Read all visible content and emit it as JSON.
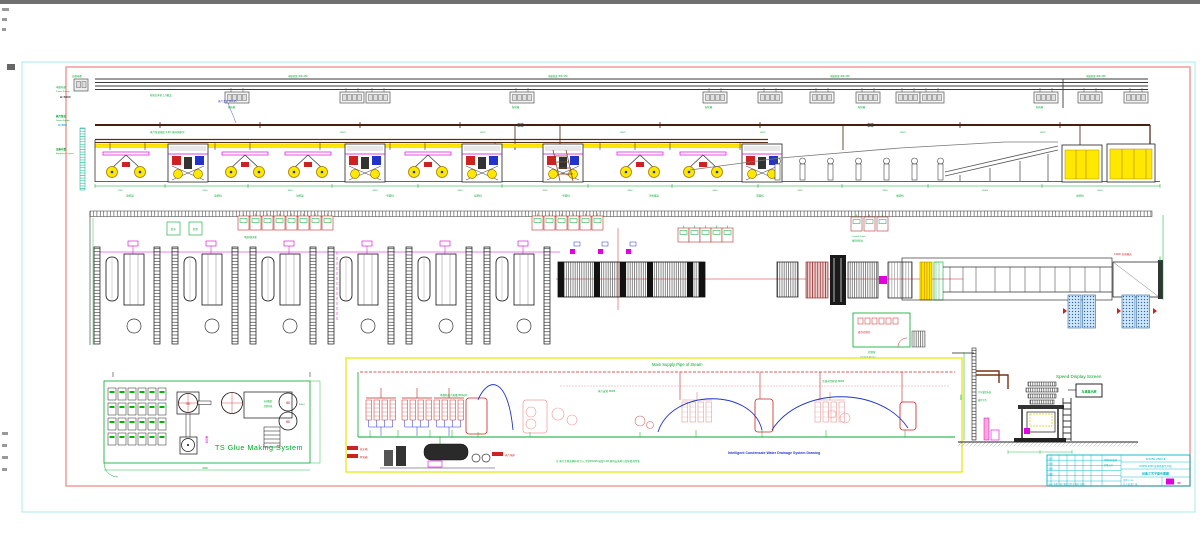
{
  "sheet": {
    "margin": {
      "power_cn": "电缆桥架",
      "power_en": "Power Supply",
      "power_elev": "H=6000",
      "steam_cn": "蒸汽管道",
      "steam_en": "Steam Supply",
      "steam_elev": "H=4500",
      "equip_cn": "设备布置",
      "equip_en": "Equipment Layout"
    },
    "cable": {
      "tray_label": "电缆桥架 300×150",
      "box_label": "配电箱",
      "main_box": "总配电柜",
      "note": "桥架沿天桥上方敷设"
    },
    "steam": {
      "main_label": "蒸汽主管 DN125",
      "note1": "蒸汽管道坡度 0.3% 坡向锅炉房",
      "branch_label": "DN25"
    },
    "elevation": {
      "dims": [
        "1700",
        "6500",
        "4500",
        "6500",
        "4500",
        "6500",
        "9000",
        "4000",
        "3500",
        "9500",
        "14000",
        "8000"
      ],
      "stations": [
        "原纸架",
        "接纸机",
        "原纸架",
        "单面机",
        "接纸机",
        "单面机",
        "天桥输送",
        "双面机",
        "横切机",
        "堆码机"
      ]
    },
    "plan": {
      "glue_box1": "胶水",
      "glue_box2": "胶泵",
      "cab_row1_label": "单面机配电柜",
      "control_panel_1": "Control Panel",
      "control_panel_2": "操作按钮站",
      "conveyor_label": "14000 自动输送",
      "control_room_interior": "操作控制台",
      "control_room_cn": "控制室",
      "control_room_en": "Control Room",
      "right_dim": "4500"
    },
    "glue_system": {
      "title": "TS Glue Making System",
      "mixer": "拌胶",
      "platform_1": "自动配胶",
      "platform_2": "控制系统",
      "storage_vol": "8000L",
      "tank_label": "储胶",
      "pump": "输胶泵",
      "dim_w": "2600"
    },
    "piping": {
      "title": "Main Supply Pipe of Steam",
      "hx_note": "单面机蒸汽耗量 800kg/h",
      "branch_note": "蒸汽支管 DN65",
      "return_note": "冷凝水回收管 DN50",
      "soft_tank": "软水箱",
      "deaerator": "除氧器",
      "boiler": "蒸汽锅炉",
      "subtitle": "Intelligent Condensate Water Drainage System Drawing",
      "note": "注:蒸汽主管由锅炉房引入,主管DN125,坡度0.3%,现场安装时以实际情况为准"
    },
    "speed": {
      "title": "Speed Display Screen",
      "display": "车速显示屏",
      "note1": "行车梁底标高",
      "note2": "操作平台",
      "dim1": "3500"
    },
    "title_block": {
      "drawing_no": "WJ250-2500-Ⅱ",
      "project": "WJ250-2500 瓦楞纸板生产线",
      "sheet_title": "设备工艺平面布置图",
      "company1": "纸箱机械设备",
      "company2": "有限公司",
      "roles": [
        "设计",
        "校对",
        "审核",
        "批准"
      ],
      "fields_row": "标记 处数 分区 更改文件号 签名 日期",
      "scale": "比例 1:100",
      "sheets": "共 1 张 第 1 张",
      "logo": "JC"
    }
  }
}
